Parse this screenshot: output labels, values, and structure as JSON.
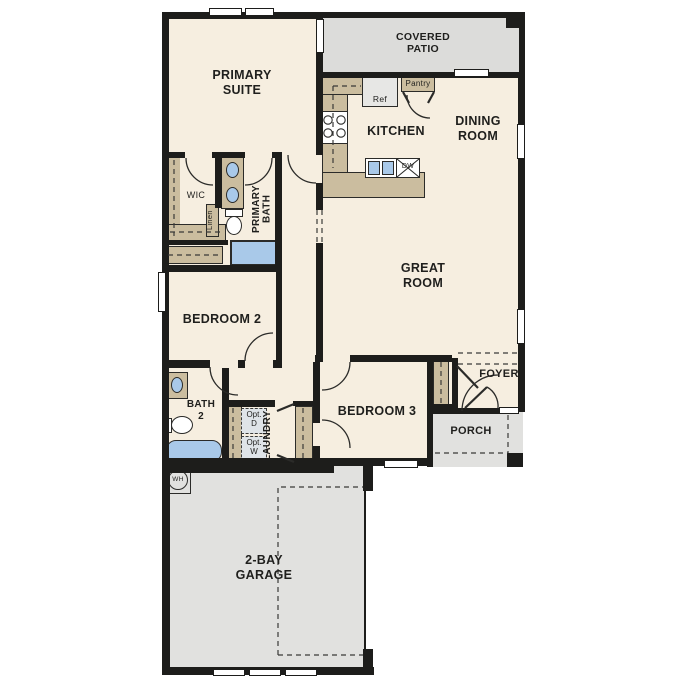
{
  "plan": {
    "title": "Single-story residence floor plan",
    "rooms": {
      "covered_patio": {
        "l1": "COVERED",
        "l2": "PATIO"
      },
      "primary_suite": {
        "l1": "PRIMARY",
        "l2": "SUITE"
      },
      "kitchen": {
        "l1": "KITCHEN"
      },
      "dining_room": {
        "l1": "DINING",
        "l2": "ROOM"
      },
      "great_room": {
        "l1": "GREAT",
        "l2": "ROOM"
      },
      "wic": {
        "l1": "WIC"
      },
      "primary_bath": {
        "l1": "PRIMARY",
        "l2": "BATH"
      },
      "linen": {
        "l1": "Linen"
      },
      "bedroom_2": {
        "l1": "BEDROOM 2"
      },
      "bath_2": {
        "l1": "BATH",
        "l2": "2"
      },
      "laundry": {
        "l1": "LAUNDRY"
      },
      "bedroom_3": {
        "l1": "BEDROOM 3"
      },
      "foyer": {
        "l1": "FOYER"
      },
      "porch": {
        "l1": "PORCH"
      },
      "garage": {
        "l1": "2-BAY",
        "l2": "GARAGE"
      }
    },
    "features": {
      "ref": {
        "l1": "Ref"
      },
      "pantry": {
        "l1": "Pantry"
      },
      "dw": {
        "l1": "DW"
      },
      "wh": {
        "l1": "WH"
      },
      "opt_d": {
        "l1": "Opt.",
        "l2": "D"
      },
      "opt_w": {
        "l1": "Opt.",
        "l2": "W"
      }
    },
    "colors": {
      "wall": "#1d1d1b",
      "interior_floor": "#f6eee0",
      "outdoor_floor": "#dcdcda",
      "cabinet_tan": "#cbbd9f",
      "plumbing_blue": "#a9c9e9",
      "optional_appliance": "#dfe4e8"
    }
  }
}
